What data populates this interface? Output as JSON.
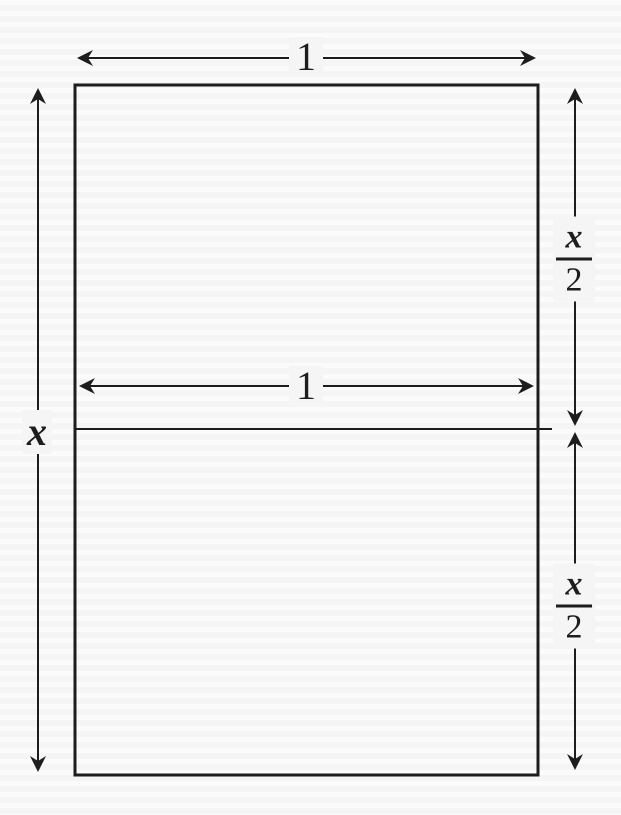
{
  "diagram": {
    "labels": {
      "top_width": "1",
      "inner_width": "1",
      "total_height": "x",
      "upper_half_height": {
        "numerator": "x",
        "denominator": "2"
      },
      "lower_half_height": {
        "numerator": "x",
        "denominator": "2"
      }
    },
    "colors": {
      "line": "#1d1d1d",
      "paper": "#f5f5f6",
      "stripe": "#fbfbfc"
    }
  }
}
